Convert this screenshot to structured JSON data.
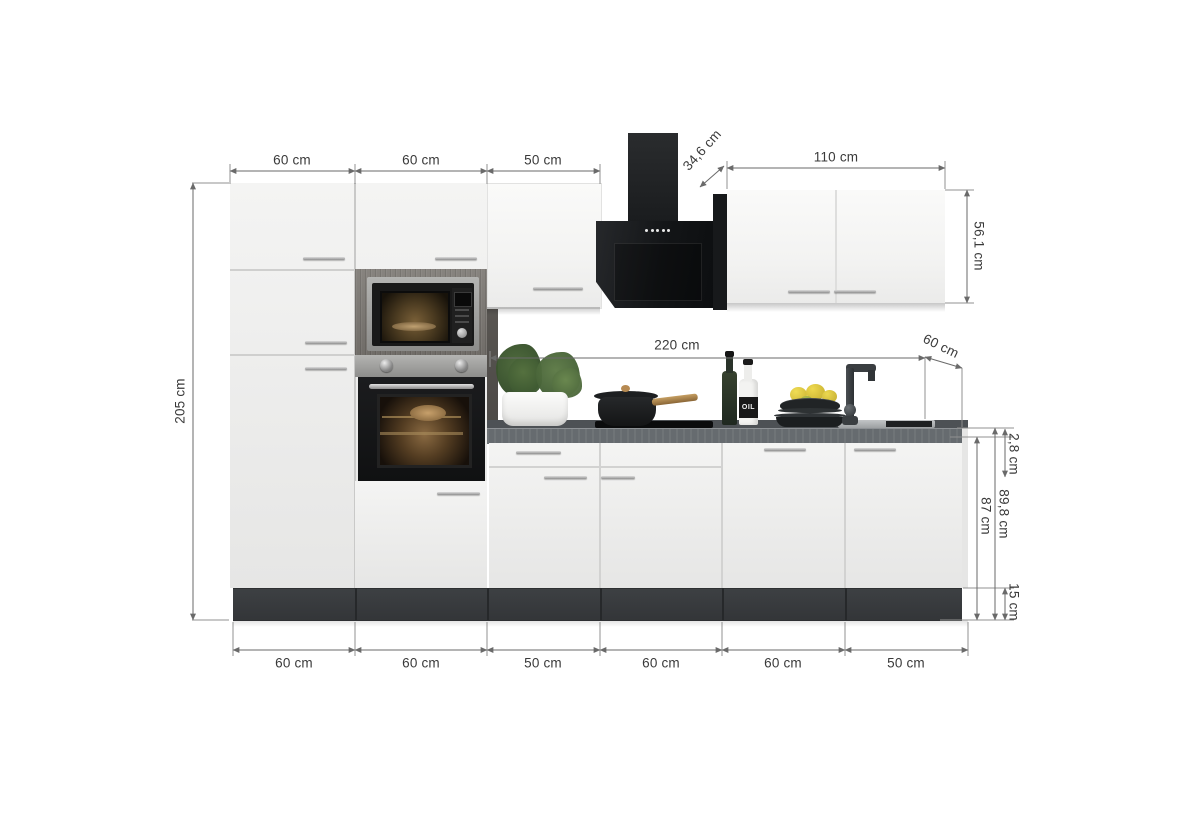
{
  "diagram": {
    "title": "Kitchen unit with appliances - dimension diagram",
    "unit": "cm"
  },
  "dimensions": {
    "top_widths": [
      "60 cm",
      "60 cm",
      "50 cm"
    ],
    "hood_depth": "34,6 cm",
    "wall_cabinet_width": "110 cm",
    "wall_cabinet_height": "56,1 cm",
    "total_height": "205 cm",
    "worktop_length": "220 cm",
    "worktop_depth": "60 cm",
    "worktop_thickness": "2,8 cm",
    "base_total_height": "89,8 cm",
    "base_cabinet_height": "87 cm",
    "plinth_height": "15 cm",
    "bottom_widths": [
      "60 cm",
      "60 cm",
      "50 cm",
      "60 cm",
      "60 cm",
      "50 cm"
    ]
  },
  "decor": {
    "oil_bottle_label": "OIL"
  },
  "colors": {
    "cabinet_front": "#f1f1f0",
    "plinth": "#37393c",
    "worktop": "#666b6f",
    "appliance_black": "#141516",
    "steel": "#a6a6a4",
    "dimension_line": "#6a6a6a",
    "dimension_text": "#3a3a3a"
  }
}
